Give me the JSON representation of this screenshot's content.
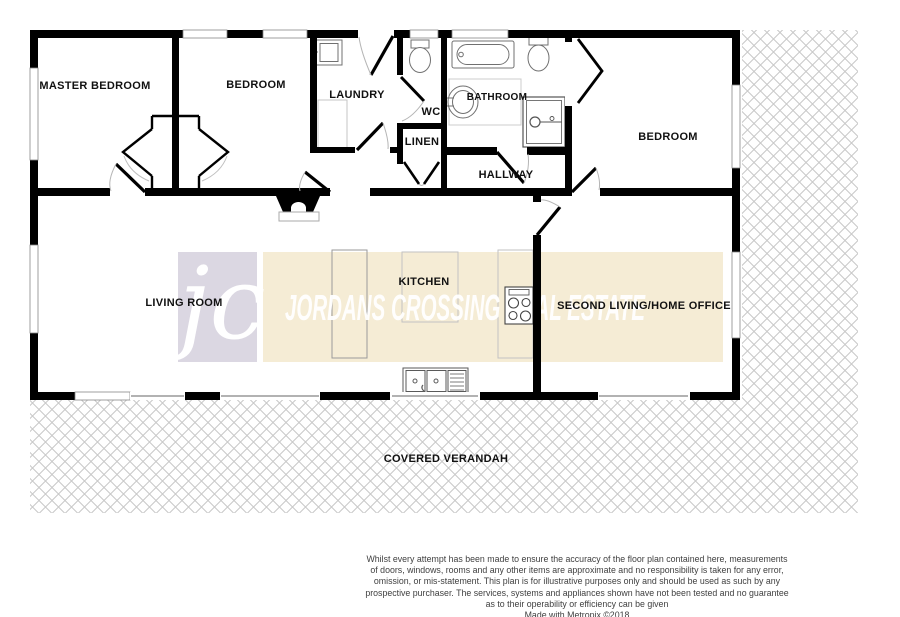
{
  "watermark": {
    "logo_initials": "jc",
    "brand_text": "JORDANS CROSSING REAL ESTATE"
  },
  "rooms": {
    "master_bedroom": "MASTER BEDROOM",
    "bedroom_2": "BEDROOM",
    "laundry": "LAUNDRY",
    "wc": "WC",
    "linen": "LINEN",
    "bathroom": "BATHROOM",
    "hallway": "HALLWAY",
    "bedroom_3": "BEDROOM",
    "living_room": "LIVING ROOM",
    "kitchen": "KITCHEN",
    "second_living": "SECOND LIVING/HOME OFFICE",
    "verandah": "COVERED VERANDAH"
  },
  "disclaimer": {
    "line1": "Whilst every attempt has been made to ensure the accuracy of the floor plan contained here, measurements",
    "line2": "of doors, windows, rooms and any other items are approximate and no responsibility is taken for any error,",
    "line3": "omission, or mis-statement. This plan is for illustrative purposes only and should be used as such by any",
    "line4": "prospective purchaser. The services, systems and appliances shown have not been tested and no guarantee",
    "line5": "as to their operability or efficiency can be given",
    "line6": "Made with Metropix ©2018"
  },
  "colors": {
    "wall": "#000000",
    "hatch_line": "#c8c8c8",
    "watermark_logo_bg": "#dbd7e2",
    "watermark_band_bg": "#f5ecd5",
    "fixture_outline": "#808080",
    "disclaimer_text": "#3f3f3f"
  }
}
